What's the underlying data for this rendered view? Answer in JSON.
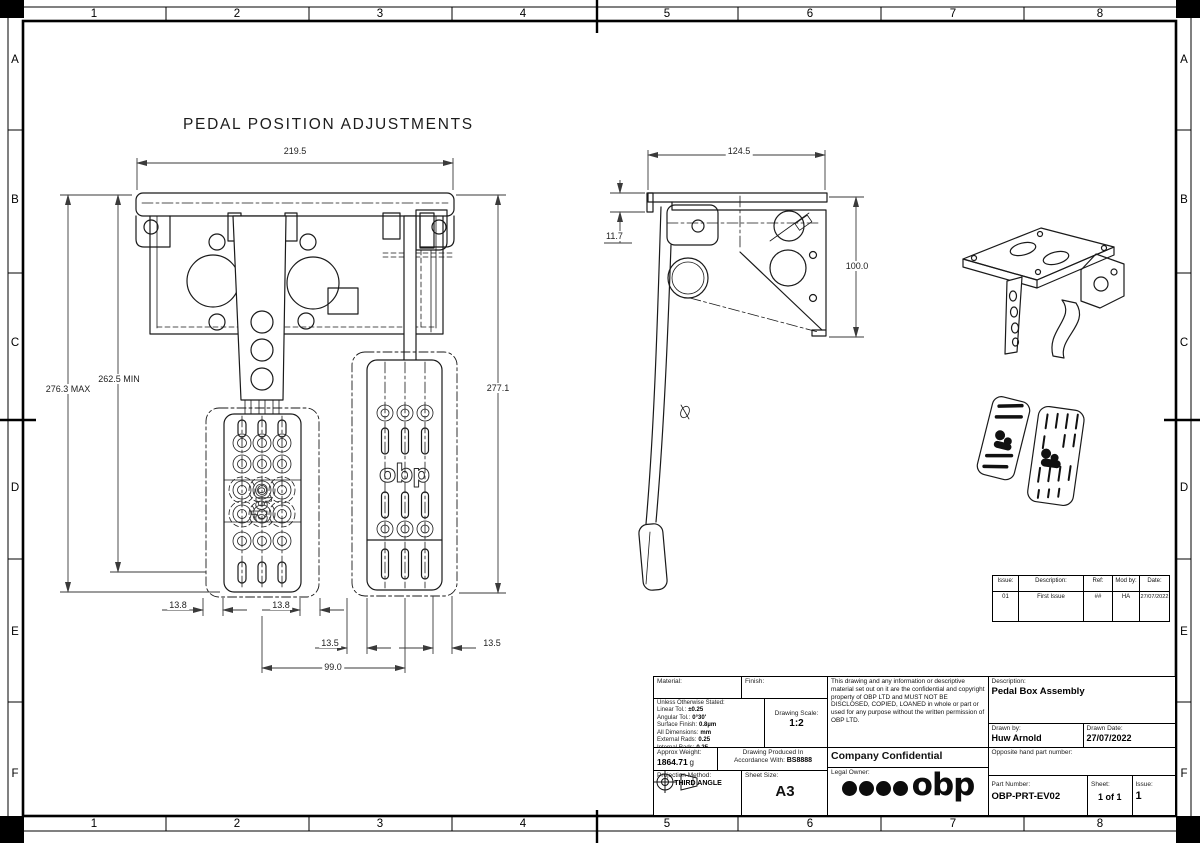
{
  "drawing": {
    "view_title": "PEDAL POSITION ADJUSTMENTS",
    "logo_text": "obp"
  },
  "border": {
    "cols": [
      "1",
      "2",
      "3",
      "4",
      "5",
      "6",
      "7",
      "8"
    ],
    "rows": [
      "A",
      "B",
      "C",
      "D",
      "E",
      "F"
    ]
  },
  "dims": {
    "front_width": "219.5",
    "front_max": "276.3 MAX",
    "front_min": "262.5 MIN",
    "front_right_height": "277.1",
    "adj_left_a": "13.8",
    "adj_left_b": "13.8",
    "adj_right_a": "13.5",
    "adj_right_b": "13.5",
    "pedal_spacing": "99.0",
    "side_width": "124.5",
    "side_flange": "11.7",
    "side_height": "100.0"
  },
  "revision_table": {
    "headers": [
      "Issue:",
      "Description:",
      "Ref:",
      "Mod by:",
      "Date:"
    ],
    "row": [
      "01",
      "First Issue",
      "##",
      "HA",
      "27/07/2022"
    ]
  },
  "title_block": {
    "material_label": "Material:",
    "finish_label": "Finish:",
    "tol_heading": "Unless Otherwise Stated:",
    "tolerances": [
      {
        "label": "Linear Tol.:",
        "value": "±0.25"
      },
      {
        "label": "Angular Tol.:",
        "value": "0°30'"
      },
      {
        "label": "Surface Finish:",
        "value": "0.8µm"
      },
      {
        "label": "All Dimensions:",
        "value": "mm"
      },
      {
        "label": "External Rads:",
        "value": "0.25"
      },
      {
        "label": "Internal Rads:",
        "value": "0.25"
      }
    ],
    "tol_footer": "BREAK ALL SHARP EDGES",
    "scale_label": "Drawing Scale:",
    "scale_value": "1:2",
    "weight_label": "Approx Weight:",
    "weight_value": "1864.71",
    "weight_unit": "g",
    "produced_line1": "Drawing Produced In",
    "produced_line2": "Accordance With:",
    "produced_standard": "BS8888",
    "projection_label": "Projection Method:",
    "projection_value": "THIRD ANGLE",
    "sheet_size_label": "Sheet Size:",
    "sheet_size_value": "A3",
    "notice": "This drawing and any information or descriptive material set out on it are the confidential and copyright property of OBP LTD and MUST NOT BE DISCLOSED, COPIED, LOANED in whole or part or used for any purpose without the written permission of OBP LTD.",
    "confidential": "Company Confidential",
    "legal_owner_label": "Legal Owner:",
    "logo_text": "obp",
    "description_label": "Description:",
    "description_value": "Pedal Box Assembly",
    "drawn_by_label": "Drawn by:",
    "drawn_by_value": "Huw Arnold",
    "drawn_date_label": "Drawn Date:",
    "drawn_date_value": "27/07/2022",
    "opposite_label": "Opposite hand part number:",
    "part_number_label": "Part Number:",
    "part_number_value": "OBP-PRT-EV02",
    "sheet_label": "Sheet:",
    "sheet_value": "1 of 1",
    "issue_label": "Issue:",
    "issue_value": "1"
  }
}
